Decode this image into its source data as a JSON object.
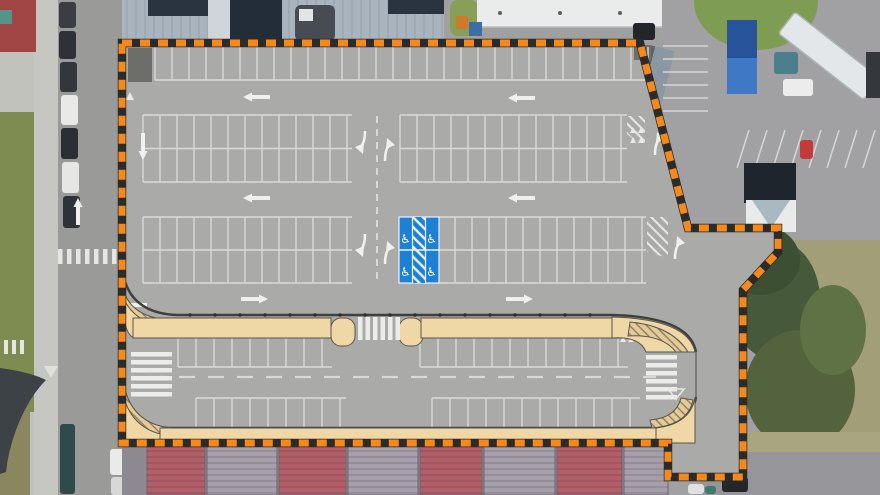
{
  "scene": {
    "type": "aerial-site-plan",
    "elements": [
      "satellite-photo-background",
      "parking-plan-overlay",
      "site-boundary"
    ]
  },
  "colors": {
    "boundary_orange": "#F5891C",
    "boundary_gap": "#2B2B29",
    "plan_gray": "#AAAAA8",
    "stall_line": "#D9D9D7",
    "marking_white": "#F0F0EE",
    "curb": "#3F3F3B",
    "sidewalk_tan": "#F0D7A6",
    "sidewalk_edge": "#5A554D",
    "accessible_blue": "#1D80D4",
    "asphalt": "#A1A1A3",
    "street_asphalt": "#9A9A98",
    "concrete": "#C6C6C2",
    "grass": "#7E8C51",
    "dry_grass": "#A19E78",
    "trees": "#4B5E3B",
    "roof_blue_gray": "#A9B4BE",
    "roof_dark": "#232D39",
    "warehouse_red": "#B25F69",
    "warehouse_gray": "#A59EAB"
  },
  "main_lot": {
    "stall_rows": [
      {
        "y0": 47,
        "y1": 80,
        "spacing": 17,
        "segments": [
          [
            155,
            648
          ]
        ],
        "h_lines": [
          80
        ]
      },
      {
        "y0": 115,
        "y1": 182,
        "spacing": 17,
        "segments": [
          [
            143,
            352
          ],
          [
            400,
            627
          ]
        ],
        "h_lines": [
          115,
          148.5,
          182
        ]
      },
      {
        "y0": 217,
        "y1": 283,
        "spacing": 17,
        "segments": [
          [
            143,
            352
          ],
          [
            438,
            646
          ]
        ],
        "h_lines": [
          217,
          250,
          283
        ]
      }
    ],
    "straight_arrows": [
      {
        "x": 243,
        "y": 97,
        "dir": "left"
      },
      {
        "x": 508,
        "y": 98,
        "dir": "left"
      },
      {
        "x": 243,
        "y": 198,
        "dir": "left"
      },
      {
        "x": 508,
        "y": 198,
        "dir": "left"
      },
      {
        "x": 268,
        "y": 299,
        "dir": "right"
      },
      {
        "x": 533,
        "y": 299,
        "dir": "right"
      },
      {
        "x": 120,
        "y": 305,
        "dir": "left"
      },
      {
        "x": 143,
        "y": 160,
        "dir": "down"
      },
      {
        "x": 78,
        "y": 198,
        "dir": "up"
      }
    ],
    "turn_arrows": [
      {
        "x": 363,
        "y": 146,
        "rot": 180
      },
      {
        "x": 387,
        "y": 146,
        "rot": 0
      },
      {
        "x": 363,
        "y": 249,
        "rot": 180
      },
      {
        "x": 387,
        "y": 249,
        "rot": 0
      },
      {
        "x": 657,
        "y": 140,
        "rot": 0
      },
      {
        "x": 677,
        "y": 244,
        "rot": 0
      }
    ],
    "center_aisle_dash": {
      "x": 377,
      "y0": 116,
      "y1": 284
    },
    "accessible_bay": {
      "x": 399,
      "y": 217,
      "w": 40,
      "h": 66,
      "hatch_x": 412.5,
      "hatch_w": 13,
      "icon": "wheelchair-icon",
      "symbol": "♿",
      "positions": [
        [
          405.5,
          243
        ],
        [
          431.5,
          243
        ],
        [
          405.5,
          276
        ],
        [
          431.5,
          276
        ]
      ]
    }
  },
  "street": {
    "stall_rows": [
      {
        "y0": 337,
        "y1": 367,
        "spacing": 18,
        "segments": [
          [
            178,
            332
          ],
          [
            420,
            628
          ]
        ],
        "h_lines": [
          337,
          367
        ]
      },
      {
        "y0": 398,
        "y1": 428,
        "spacing": 18,
        "segments": [
          [
            196,
            346
          ],
          [
            432,
            640
          ]
        ],
        "h_lines": [
          398,
          428
        ]
      }
    ],
    "centerline": {
      "y": 377,
      "x0": 150,
      "x1": 656
    },
    "crosswalks": [
      {
        "orient": "v",
        "x0": 358,
        "x1": 401,
        "y0": 317,
        "y1": 340,
        "step": 7.5,
        "w": 4.5
      },
      {
        "orient": "h",
        "x0": 131,
        "x1": 172,
        "y0": 352,
        "y1": 394,
        "step": 8,
        "w": 4.5
      },
      {
        "orient": "h",
        "x0": 646,
        "x1": 677,
        "y0": 355,
        "y1": 395,
        "step": 8,
        "w": 4.5
      }
    ]
  },
  "satellite": {
    "left_street_cars": [
      {
        "x": 59,
        "y": 2,
        "w": 17,
        "h": 26,
        "fill": "#3A3E43"
      },
      {
        "x": 59,
        "y": 31,
        "w": 17,
        "h": 28,
        "fill": "#2E3237"
      },
      {
        "x": 60,
        "y": 62,
        "w": 17,
        "h": 30,
        "fill": "#33373C"
      },
      {
        "x": 61,
        "y": 95,
        "w": 17,
        "h": 30,
        "fill": "#E9E9E7"
      },
      {
        "x": 61,
        "y": 128,
        "w": 17,
        "h": 31,
        "fill": "#2B2F34"
      },
      {
        "x": 62,
        "y": 162,
        "w": 17,
        "h": 31,
        "fill": "#E6E6E4"
      },
      {
        "x": 63,
        "y": 196,
        "w": 17,
        "h": 32,
        "fill": "#2F3338"
      },
      {
        "x": 60,
        "y": 424,
        "w": 15,
        "h": 70,
        "fill": "#2E4A4A"
      },
      {
        "x": 110,
        "y": 449,
        "w": 17,
        "h": 26,
        "fill": "#EAEAEA"
      },
      {
        "x": 111,
        "y": 477,
        "w": 15,
        "h": 18,
        "fill": "#D8D8D8"
      }
    ],
    "zebra_left_street": {
      "y": 249,
      "h": 15,
      "x0": 58,
      "x1": 112,
      "step": 9,
      "w": 4.5
    },
    "zebra_side_road": {
      "y": 340,
      "h": 14,
      "x0": 4,
      "x1": 24,
      "step": 8,
      "w": 4
    },
    "warehouse_panels": [
      {
        "x": 147,
        "w": 58,
        "fill": "#B25F69"
      },
      {
        "x": 207,
        "w": 70,
        "fill": "#A59EAB"
      },
      {
        "x": 279,
        "w": 67,
        "fill": "#B25F69"
      },
      {
        "x": 348,
        "w": 70,
        "fill": "#A59EAB"
      },
      {
        "x": 420,
        "w": 62,
        "fill": "#B25F69"
      },
      {
        "x": 484,
        "w": 71,
        "fill": "#A59EAB"
      },
      {
        "x": 557,
        "w": 65,
        "fill": "#B25F69"
      },
      {
        "x": 624,
        "w": 44,
        "fill": "#A59EAB"
      }
    ],
    "right_parking_lines_h": {
      "x0": 663,
      "x1": 708,
      "y0": 46,
      "step": 13,
      "count": 6
    },
    "right_parking_lines_slant": {
      "count": 8,
      "x0": 737,
      "step": 18,
      "y_base": 168,
      "dx": 12,
      "dy": -38
    },
    "right_yard_cars": [
      {
        "x": 783,
        "y": 79,
        "w": 30,
        "h": 17,
        "fill": "#ECECEC"
      },
      {
        "x": 800,
        "y": 140,
        "w": 13,
        "h": 19,
        "fill": "#C13B3B"
      },
      {
        "x": 722,
        "y": 477,
        "w": 26,
        "h": 15,
        "fill": "#23272C"
      },
      {
        "x": 688,
        "y": 484,
        "w": 16,
        "h": 10,
        "fill": "#E0E2E2"
      },
      {
        "x": 705,
        "y": 486,
        "w": 11,
        "h": 8,
        "fill": "#3F7A6E"
      },
      {
        "x": 633,
        "y": 23,
        "w": 22,
        "h": 17,
        "fill": "#22262B"
      }
    ]
  }
}
